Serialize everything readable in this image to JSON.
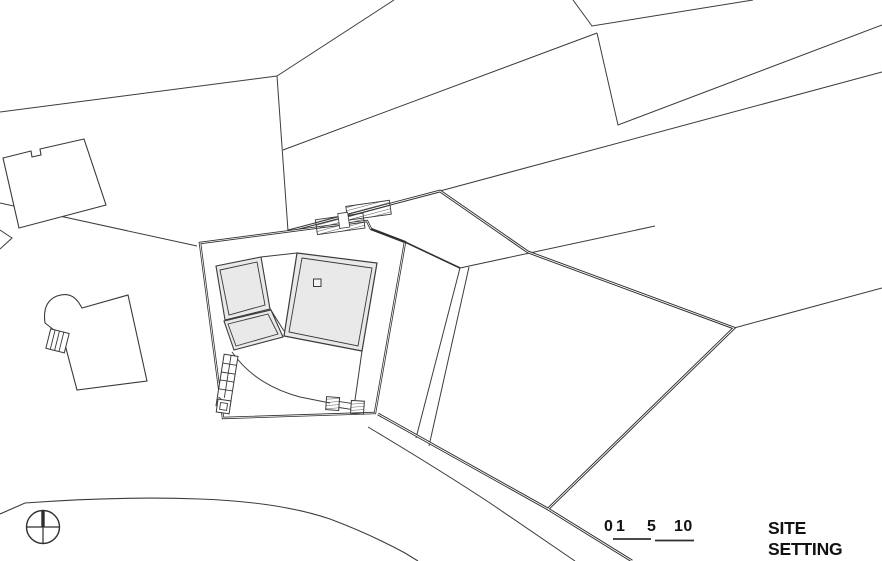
{
  "title": "SITE SETTING",
  "scale_bar": {
    "labels": {
      "l0": "0",
      "l1": "1",
      "l5": "5",
      "l10": "10"
    }
  },
  "symbols": {
    "north_symbol": "north-compass-crosshair"
  },
  "colors": {
    "ink": "#2f2f2f",
    "thin_line": "#3c3c3c",
    "building_fill": "#e9e9e9",
    "background": "#ffffff",
    "text": "#111111"
  }
}
